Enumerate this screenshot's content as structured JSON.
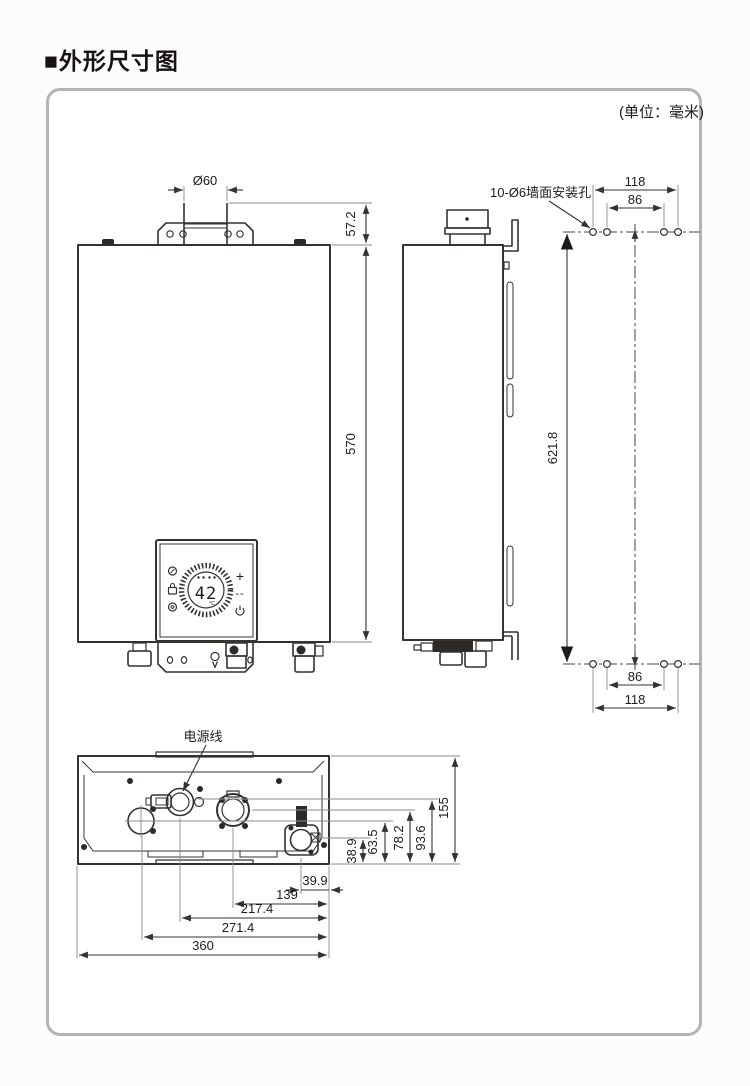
{
  "page": {
    "title": "■外形尺寸图",
    "unit_note": "(单位：毫米)"
  },
  "front": {
    "flue_diameter": "Ø60",
    "top_offset": "57.2",
    "height": "570",
    "display": {
      "temp": "42",
      "unit": "°C",
      "plus": "+",
      "minus": "--"
    }
  },
  "mounting": {
    "label": "10-Ø6墙面安装孔",
    "top_outer": "118",
    "top_inner": "86",
    "vertical": "621.8",
    "bottom_inner": "86",
    "bottom_outer": "118"
  },
  "bottom": {
    "power_label": "电源线",
    "heights": [
      "38.9",
      "63.5",
      "78.2",
      "93.6",
      "155"
    ],
    "widths": [
      "39.9",
      "139",
      "217.4",
      "271.4",
      "360"
    ]
  }
}
